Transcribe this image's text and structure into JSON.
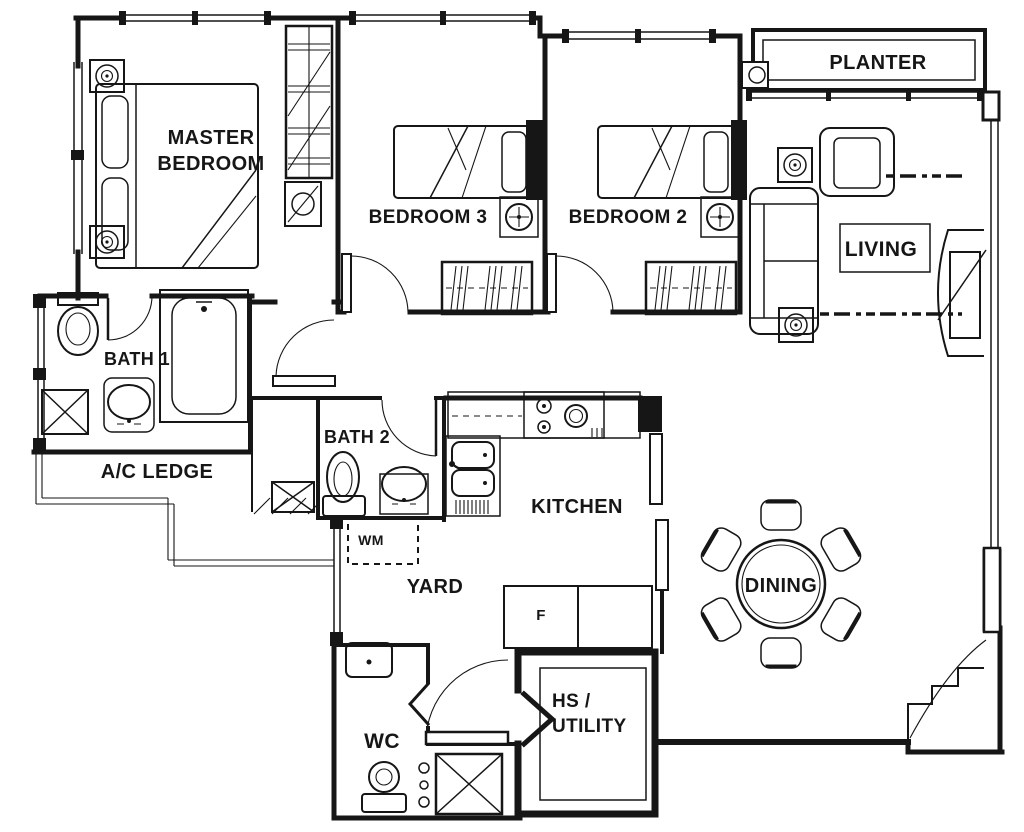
{
  "title": "3-bedroom apartment floor plan",
  "colors": {
    "ink": "#161616",
    "paper": "#ffffff"
  },
  "labels": {
    "master_bedroom": "MASTER\nBEDROOM",
    "bedroom3": "BEDROOM 3",
    "bedroom2": "BEDROOM 2",
    "planter": "PLANTER",
    "living": "LIVING",
    "bath1": "BATH 1",
    "ac_ledge": "A/C LEDGE",
    "bath2": "BATH 2",
    "kitchen": "KITCHEN",
    "wm": "WM",
    "yard": "YARD",
    "fridge": "F",
    "dining": "DINING",
    "wc": "WC",
    "hs_utility": "HS /\nUTILITY"
  },
  "fixtures": [
    "double-bed",
    "single-bed",
    "wardrobe",
    "dresser",
    "sofa",
    "armchair",
    "coffee-table",
    "tv-console",
    "dining-table",
    "dining-chair",
    "bathtub",
    "toilet",
    "wash-basin",
    "kitchen-sink",
    "hob",
    "fridge",
    "washing-machine-space",
    "ac-unit",
    "ceiling-speaker",
    "ceiling-fan-point",
    "planter-box",
    "household-shelter-door",
    "bifold-door"
  ]
}
